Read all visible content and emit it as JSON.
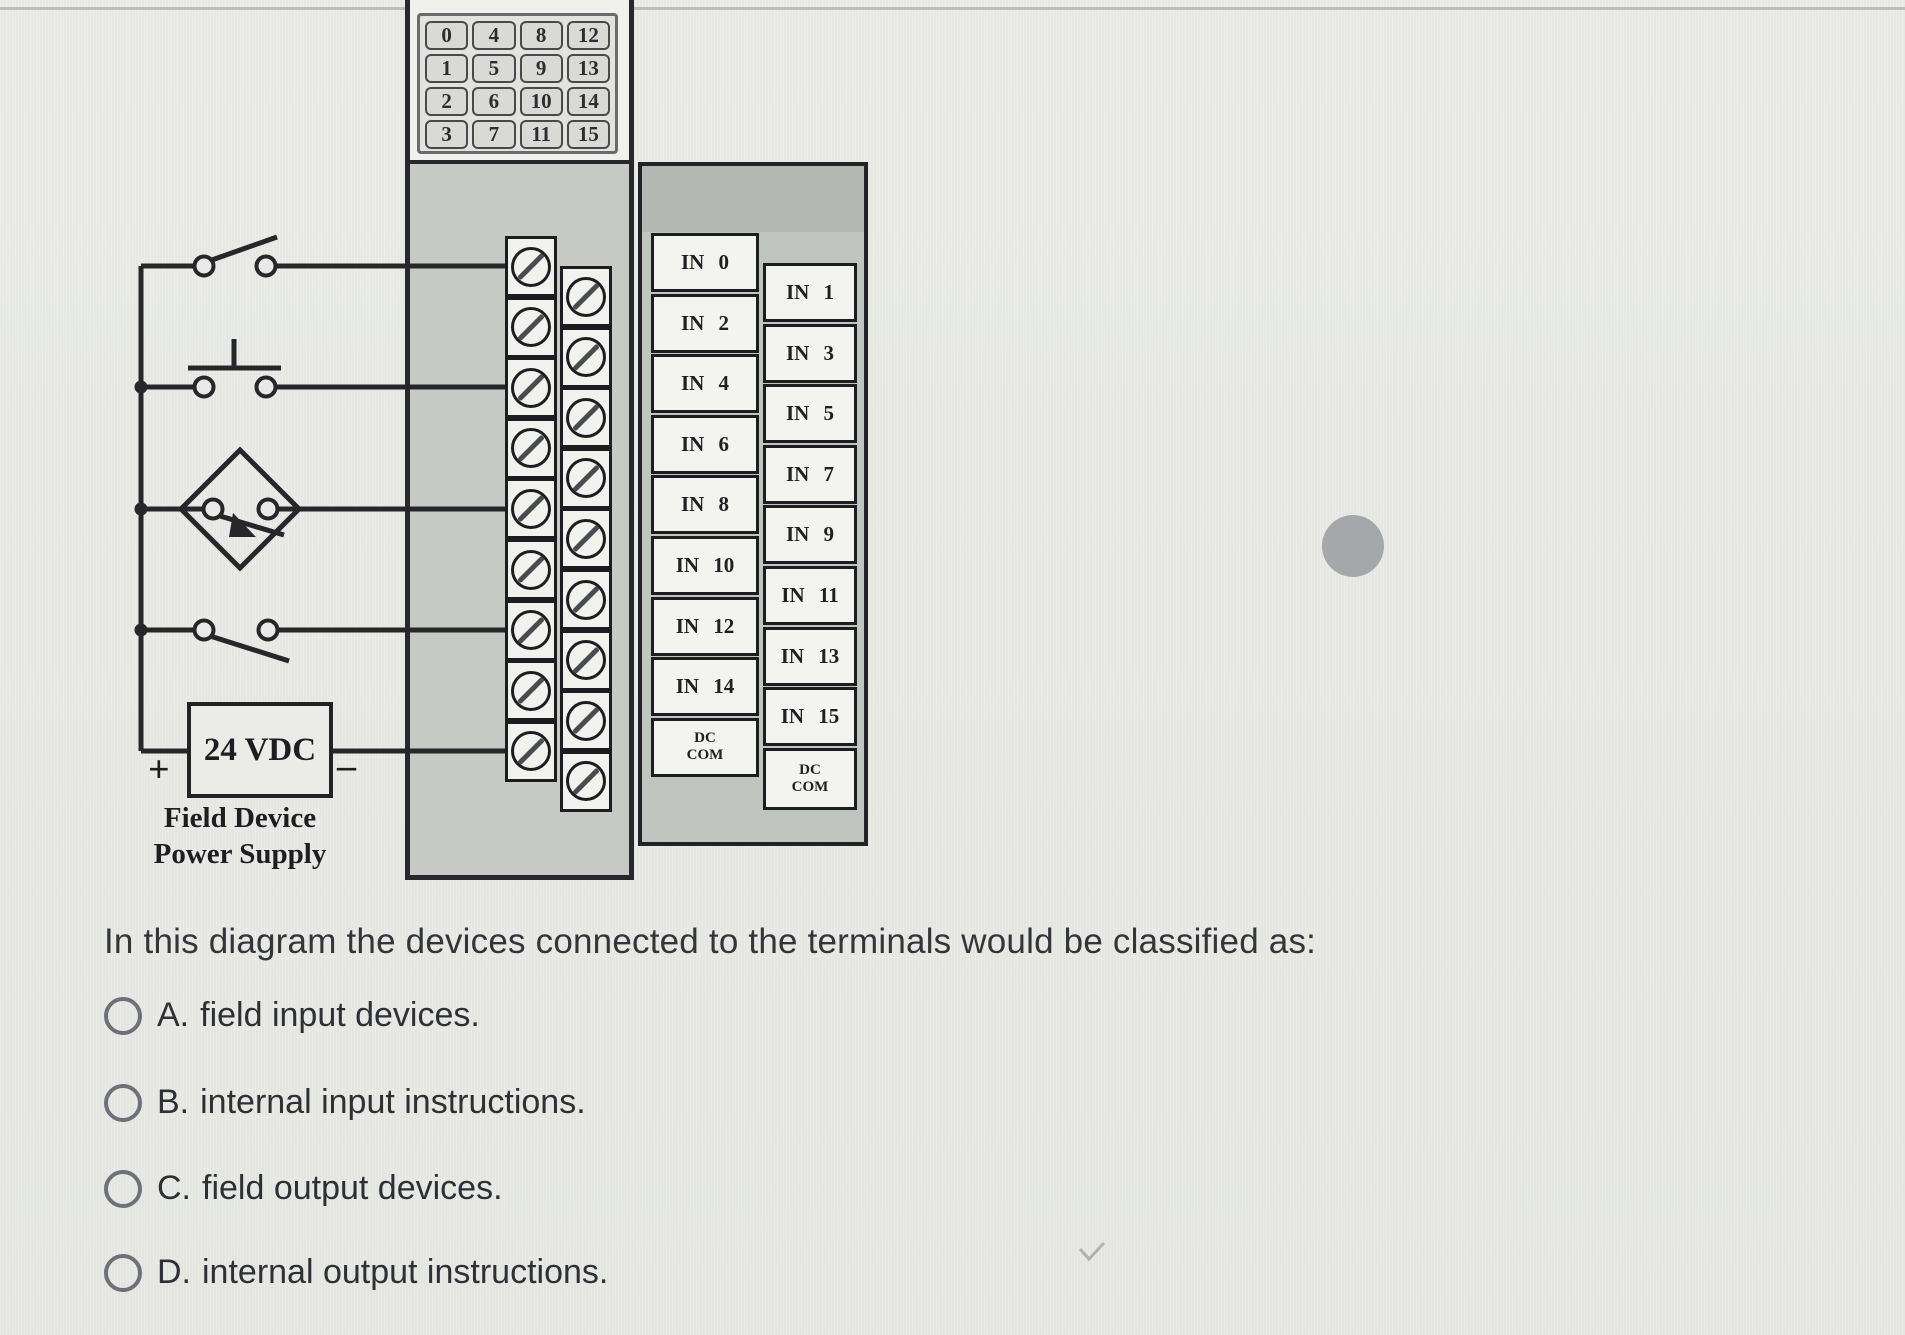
{
  "diagram": {
    "indicator_grid": {
      "rows": [
        [
          "0",
          "4",
          "8",
          "12"
        ],
        [
          "1",
          "5",
          "9",
          "13"
        ],
        [
          "2",
          "6",
          "10",
          "14"
        ],
        [
          "3",
          "7",
          "11",
          "15"
        ]
      ]
    },
    "module": {
      "left_terminal_labels": [
        "IN 0",
        "IN 2",
        "IN 4",
        "IN 6",
        "IN 8",
        "IN 10",
        "IN 12",
        "IN 14",
        "DC\nCOM"
      ],
      "right_terminal_labels": [
        "IN 1",
        "IN 3",
        "IN 5",
        "IN 7",
        "IN 9",
        "IN 11",
        "IN 13",
        "IN 15",
        "DC\nCOM"
      ]
    },
    "field_device_symbols": [
      "toggle-switch",
      "pushbutton-no",
      "proximity-sensor",
      "limit-switch"
    ],
    "power_supply": {
      "label": "24 VDC",
      "plus": "+",
      "minus": "–",
      "caption_line1": "Field Device",
      "caption_line2": "Power Supply"
    }
  },
  "question": {
    "text": "In this diagram the devices connected to the terminals would be classified as:"
  },
  "options": [
    {
      "letter": "A.",
      "text": "field input devices."
    },
    {
      "letter": "B.",
      "text": "internal input instructions."
    },
    {
      "letter": "C.",
      "text": "field output devices."
    },
    {
      "letter": "D.",
      "text": "internal output instructions."
    }
  ],
  "colors": {
    "page_bg": "#e9eae6",
    "wire": "#26262b",
    "module_gray": "#c7c9c4",
    "panel_gray": "#c1c5c0",
    "indicator_cell_bg": "#d9dad6",
    "label_box_bg": "#f3f4f0",
    "screw_box_bg": "#f1f2ee",
    "question_text": "#34353b",
    "radio_border": "#70707a",
    "gray_dot": "#a4a8ab"
  }
}
